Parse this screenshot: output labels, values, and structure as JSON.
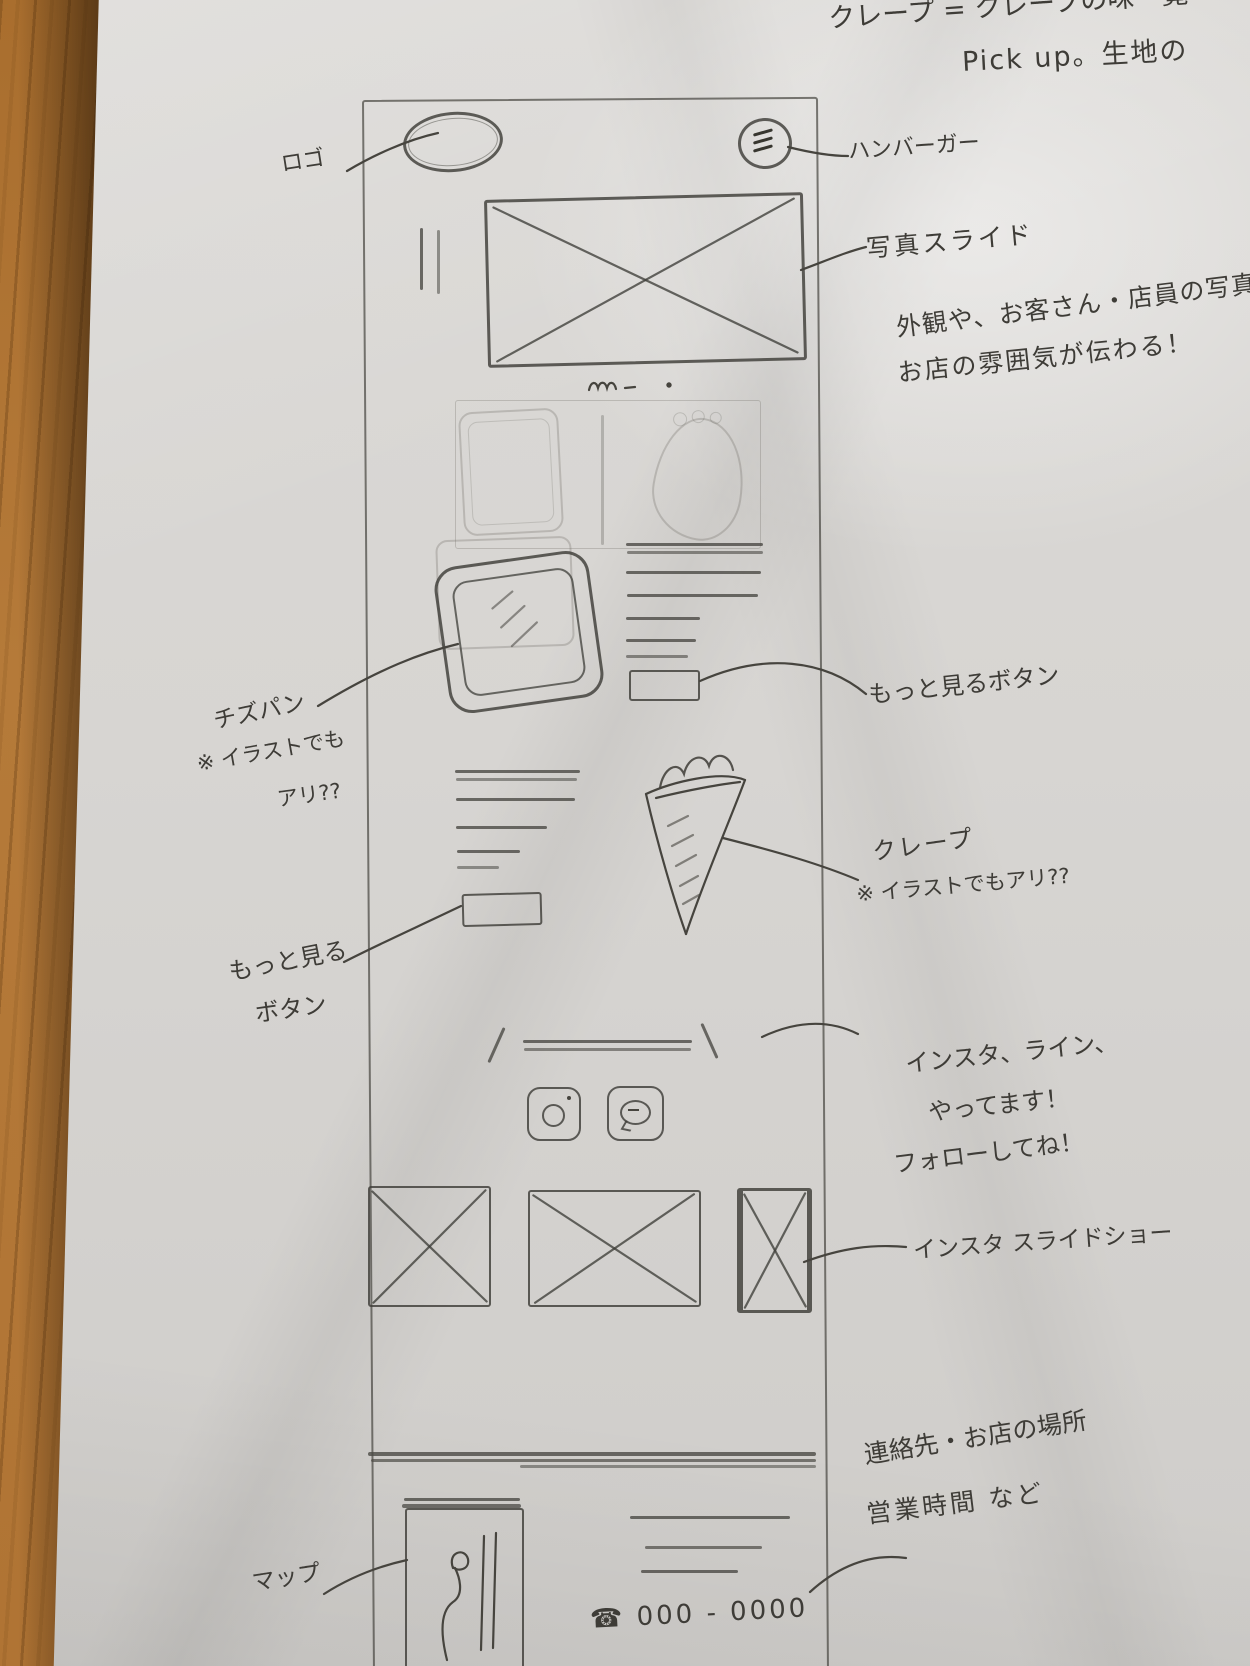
{
  "scene": {
    "description": "Photo of a hand-drawn mobile website wireframe sketch on white paper lying on a wooden desk",
    "colors": {
      "pencil": "#46443e",
      "paper": "#d7d5d2",
      "wood": "#b1762e"
    }
  },
  "top_note": {
    "line1": "クレープ = クレープの味一覧",
    "line2": "Pick up。生地の"
  },
  "annotations": {
    "logo": "ロゴ",
    "hamburger": "ハンバーガー",
    "photo_slide": {
      "line1": "写真スライド",
      "line2": "外観や、お客さん・店員の写真",
      "line3": "お店の雰囲気が伝わる！"
    },
    "cheese_bread": {
      "line1": "チズパン",
      "line2": "※ イラストでも",
      "line3": "アリ??"
    },
    "more_button_right": "もっと見るボタン",
    "crepe": {
      "line1": "クレープ",
      "line2": "※ イラストでもアリ??"
    },
    "more_button_left": {
      "line1": "もっと見る",
      "line2": "ボタン"
    },
    "sns": {
      "line1": "インスタ、ライン、",
      "line2": "やってます！",
      "line3": "フォローしてね！"
    },
    "insta_slideshow": "インスタ スライドショー",
    "footer_info": {
      "line1": "連絡先・お店の場所",
      "line2": "営業時間 など"
    },
    "map": "マップ"
  },
  "wireframe": {
    "phone_icon": "☎",
    "phone_number": "000 - 0000"
  }
}
